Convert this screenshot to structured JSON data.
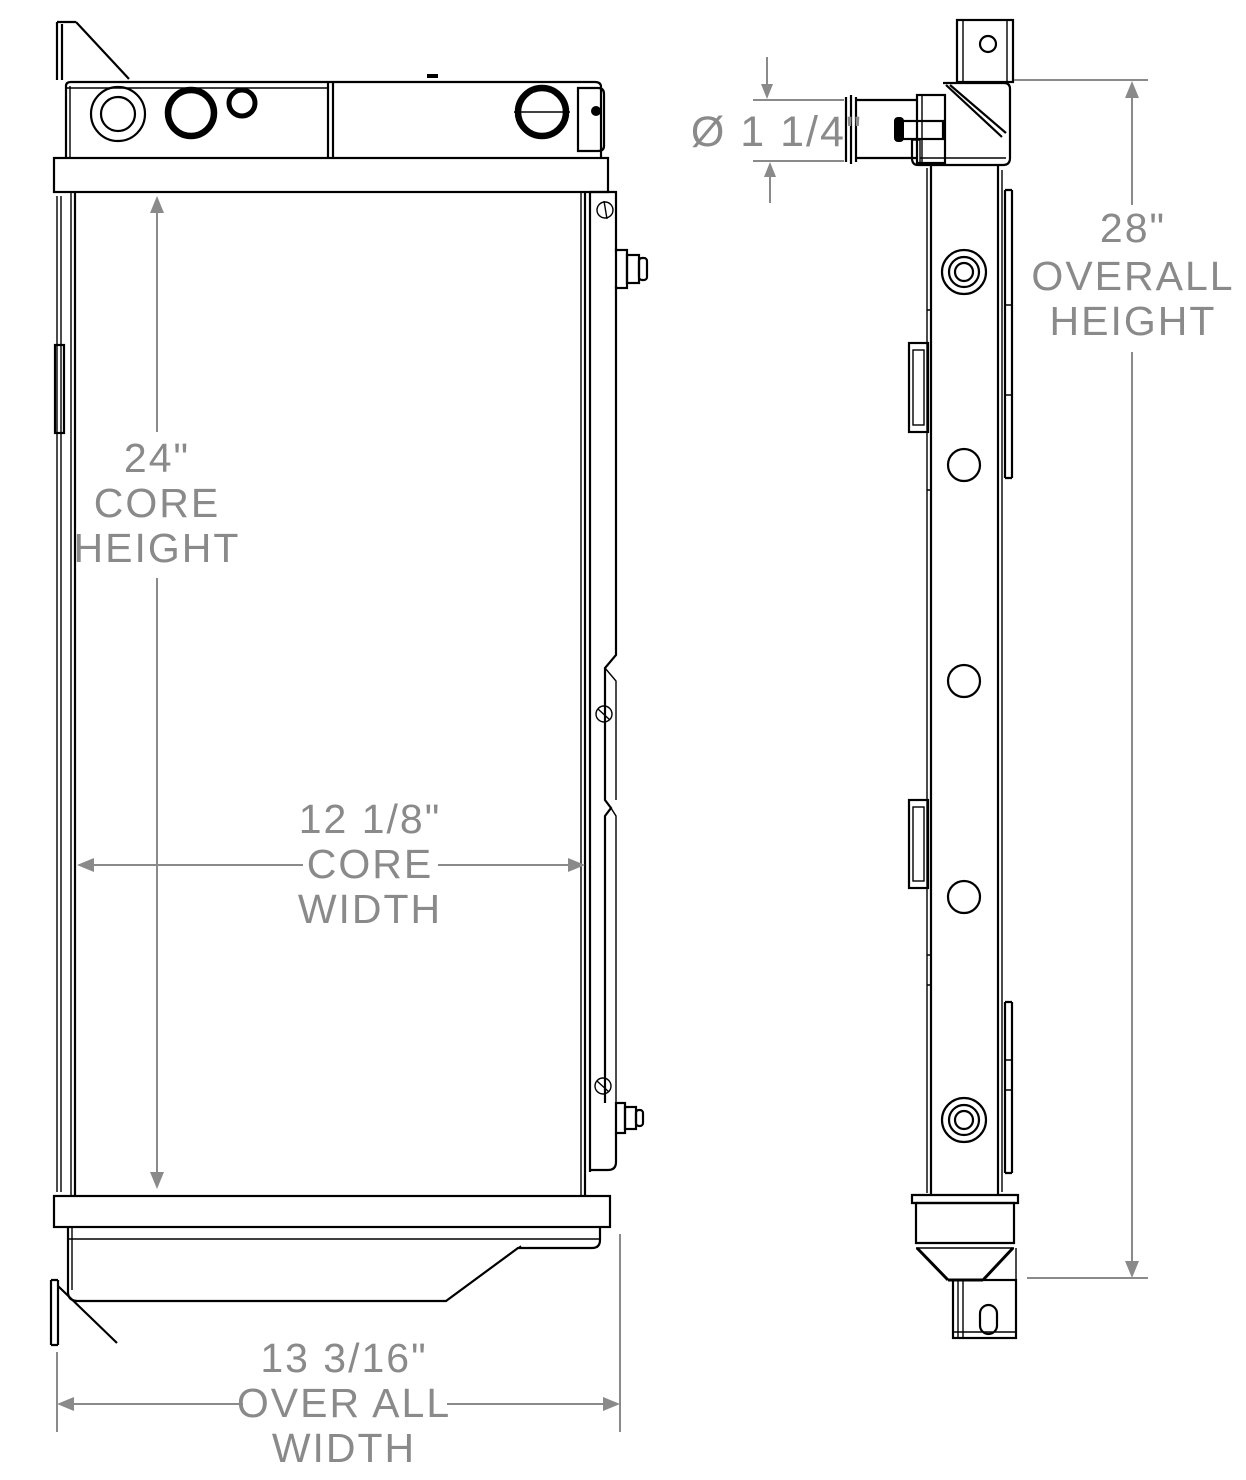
{
  "drawing": {
    "title": "radiator-technical-drawing",
    "views": {
      "front": "front-view",
      "side": "side-view"
    },
    "dimensions": {
      "core_height": {
        "value": "24\"",
        "label_line1": "CORE",
        "label_line2": "HEIGHT"
      },
      "core_width": {
        "value": "12 1/8\"",
        "label_line1": "CORE",
        "label_line2": "WIDTH"
      },
      "overall_width": {
        "value": "13 3/16\"",
        "label_line1": "OVER ALL",
        "label_line2": "WIDTH"
      },
      "overall_height": {
        "value": "28\"",
        "label_line1": "OVERALL",
        "label_line2": "HEIGHT"
      },
      "inlet_diameter": {
        "value": "Ø 1 1/4\""
      }
    },
    "colors": {
      "line": "#000000",
      "dimension": "#8a8a8a",
      "background": "#ffffff"
    }
  }
}
